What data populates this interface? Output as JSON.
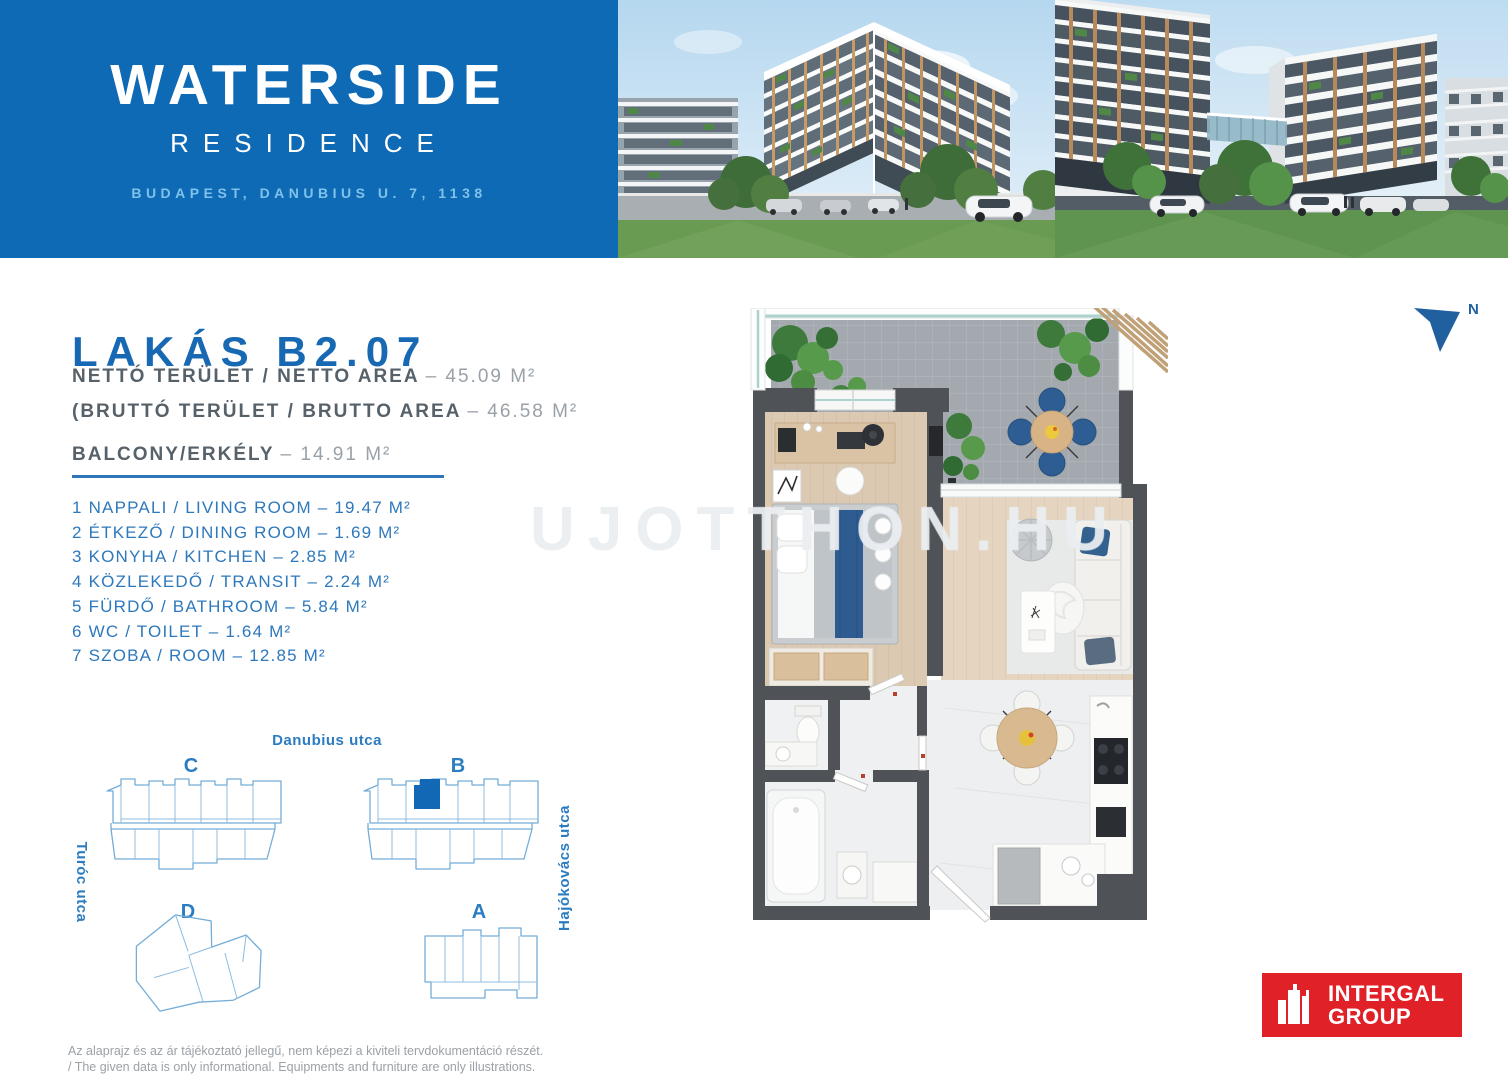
{
  "header": {
    "title": "WATERSIDE",
    "subtitle": "RESIDENCE",
    "address": "BUDAPEST, DANUBIUS U. 7, 1138"
  },
  "unit": {
    "title": "LAKÁS B2.07",
    "areas": [
      {
        "label": "NETTÓ TERÜLET / NETTO AREA",
        "value": "– 45.09 M²"
      },
      {
        "label": "(BRUTTÓ TERÜLET / BRUTTO AREA",
        "value": "– 46.58 M²"
      },
      {
        "label": "BALCONY/ERKÉLY",
        "value": "– 14.91 M²"
      }
    ],
    "rooms": [
      "1 NAPPALI / LIVING ROOM – 19.47 M²",
      "2 ÉTKEZŐ / DINING ROOM – 1.69 M²",
      "3 KONYHA / KITCHEN – 2.85 M²",
      "4 KÖZLEKEDŐ / TRANSIT – 2.24 M²",
      "5 FÜRDŐ / BATHROOM – 5.84 M²",
      "6 WC / TOILET – 1.64 M²",
      "7 SZOBA / ROOM – 12.85 M²"
    ]
  },
  "siteplan": {
    "street_top": "Danubius utca",
    "street_left": "Turóc utca",
    "street_right": "Hajókovács utca",
    "buildings": [
      {
        "label": "C"
      },
      {
        "label": "B",
        "highlighted_unit": "B2.07"
      },
      {
        "label": "D"
      },
      {
        "label": "A"
      }
    ]
  },
  "compass": {
    "north_label": "N"
  },
  "watermark": "UJOTTHON.HU",
  "footer": {
    "disclaimer_hu": "Az alaprajz és az ár tájékoztató jellegű, nem képezi a kiviteli tervdokumentáció részét.",
    "disclaimer_en": "/ The given data is only informational. Equipments and furniture are only illustrations.",
    "logo": {
      "line1": "INTERGAL",
      "line2": "GROUP"
    }
  },
  "colors": {
    "brand_blue": "#0e6ab5",
    "address_blue": "#7fc2ea",
    "title_blue": "#1769b3",
    "list_blue": "#2e78bc",
    "outline_blue": "#74add8",
    "highlight_blue": "#1268b4",
    "logo_red": "#e02127",
    "label_gray": "#57616a",
    "value_gray": "#99a1a8"
  }
}
